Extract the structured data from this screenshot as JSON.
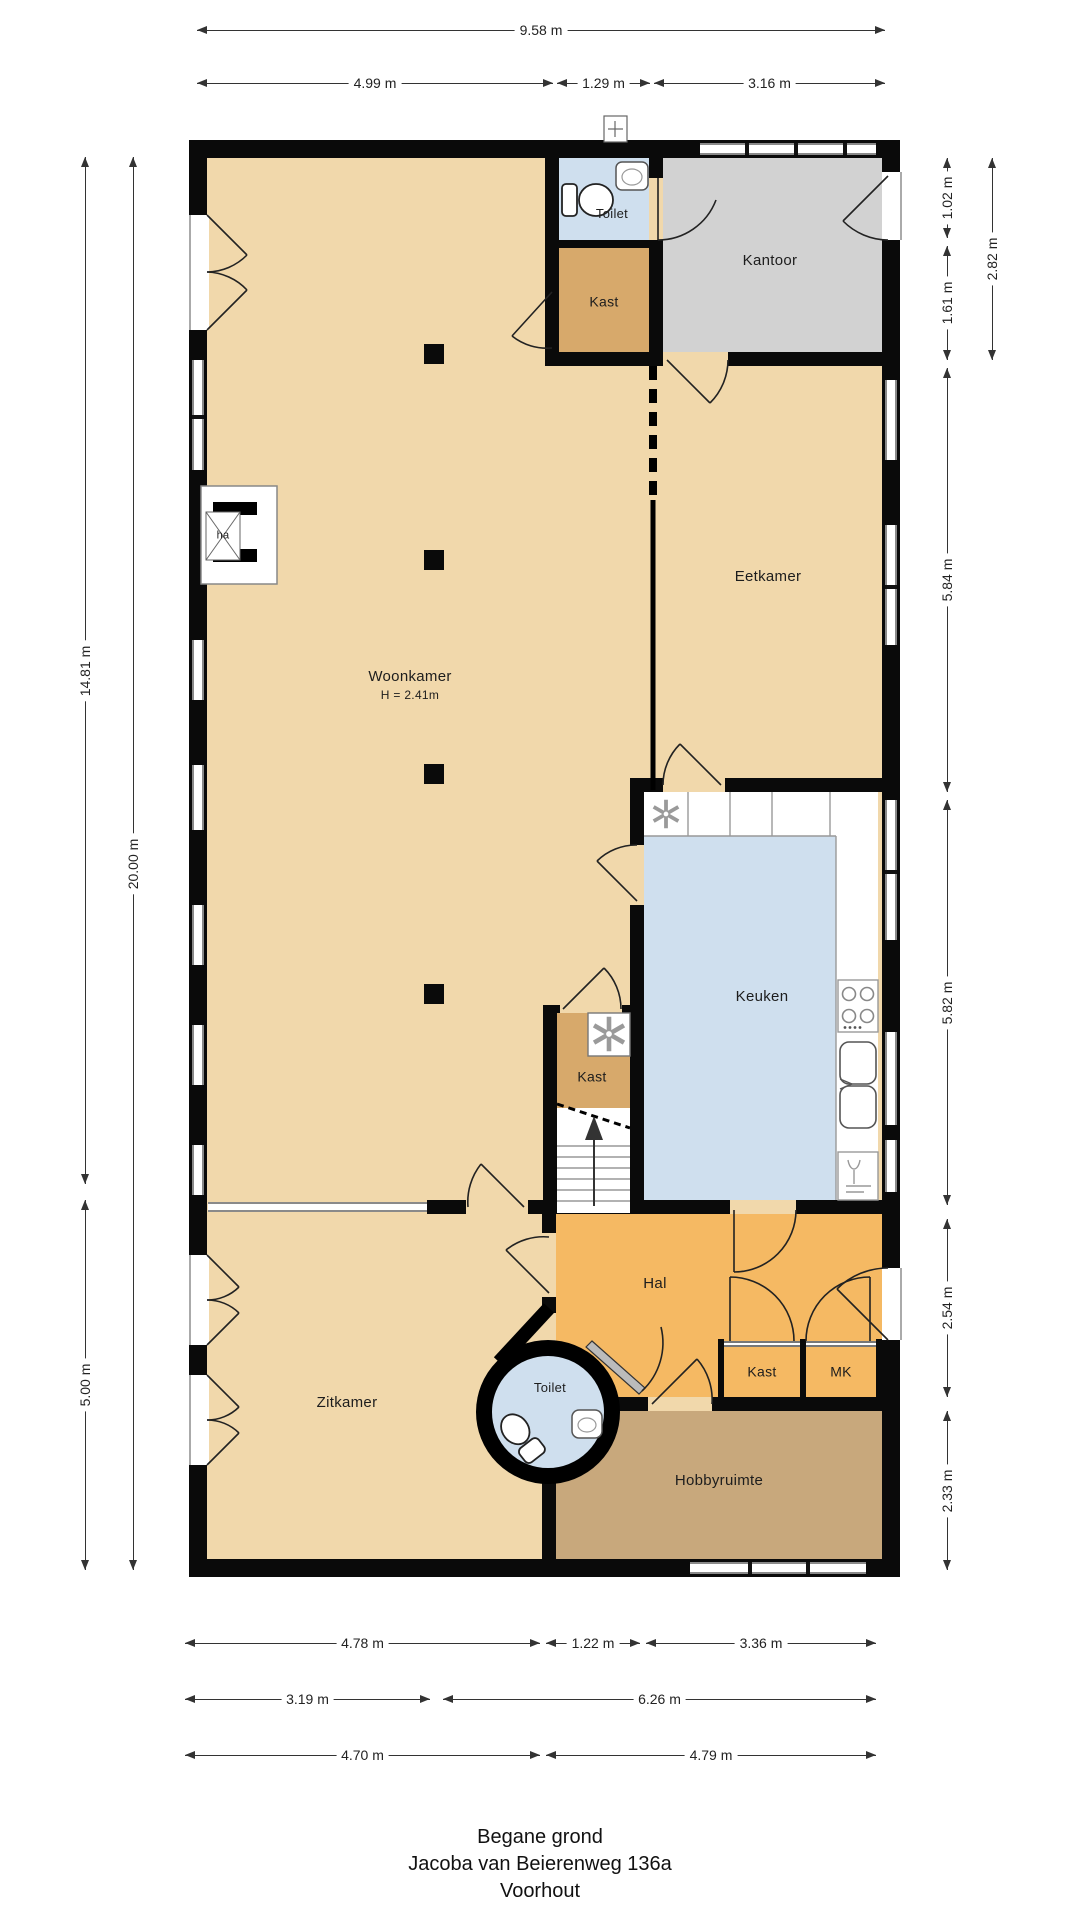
{
  "plan": {
    "woonkamer": {
      "label": "Woonkamer",
      "height": "H = 2.41m"
    },
    "eetkamer": {
      "label": "Eetkamer"
    },
    "keuken": {
      "label": "Keuken"
    },
    "kantoor": {
      "label": "Kantoor"
    },
    "toilet_boven": {
      "label": "Toilet"
    },
    "kast_boven": {
      "label": "Kast"
    },
    "kast_midden": {
      "label": "Kast"
    },
    "hal": {
      "label": "Hal"
    },
    "zitkamer": {
      "label": "Zitkamer"
    },
    "toilet_hal": {
      "label": "Toilet"
    },
    "kast_hal": {
      "label": "Kast"
    },
    "mk": {
      "label": "MK"
    },
    "hobbyruimte": {
      "label": "Hobbyruimte"
    },
    "fireplace": {
      "label": "ha"
    }
  },
  "dims": {
    "top": [
      "9.58 m",
      "4.99 m",
      "1.29 m",
      "3.16 m"
    ],
    "left": [
      "14.81 m",
      "20.00 m",
      "5.00 m"
    ],
    "right": [
      "1.02 m",
      "2.82 m",
      "1.61 m",
      "5.84 m",
      "5.82 m",
      "2.54 m",
      "2.33 m"
    ],
    "bottom": [
      "4.78 m",
      "1.22 m",
      "3.36 m",
      "3.19 m",
      "6.26 m",
      "4.70 m",
      "4.79 m"
    ]
  },
  "title": {
    "floor": "Begane grond",
    "address": "Jacoba van Beierenweg 136a",
    "city": "Voorhout"
  },
  "colors": {
    "floor_tan": "#f1d8ab",
    "floor_closet": "#d7a96b",
    "floor_office": "#d2d2d2",
    "floor_wet": "#cfdfee",
    "floor_hall": "#f5b963",
    "floor_hobby": "#c8a87c",
    "wall": "#0a0a0a"
  }
}
